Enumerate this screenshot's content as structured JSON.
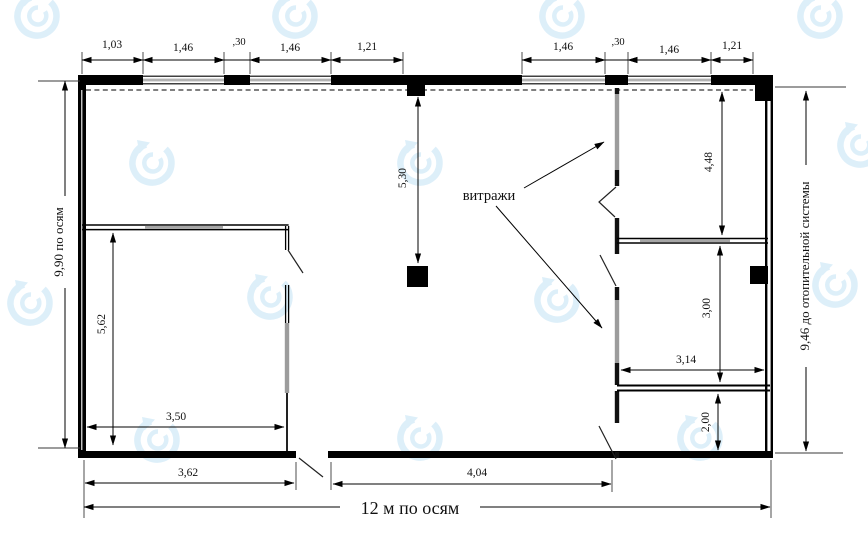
{
  "watermark": {
    "color": "#c9e5f6"
  },
  "drawing": {
    "annotation": "витражи",
    "axis_labels": {
      "left": "9,90 по осям",
      "right": "9,46 до отопительной системы",
      "bottom": "12 м по осям"
    },
    "top_dims": [
      "1,03",
      "1,46",
      ",30",
      "1,46",
      "1,21",
      "1,46",
      ",30",
      "1,46",
      "1,21"
    ],
    "vertical_dims": {
      "glazing_axis": "5,30",
      "right_room_upper": "4,48",
      "right_room_mid": "3,00",
      "right_room_lower": "2,00",
      "left_room": "5,62"
    },
    "horizontal_dims": {
      "right_room_width": "3,14",
      "left_room_width": "3,50",
      "bottom_left": "3,62",
      "bottom_mid": "4,04"
    }
  }
}
